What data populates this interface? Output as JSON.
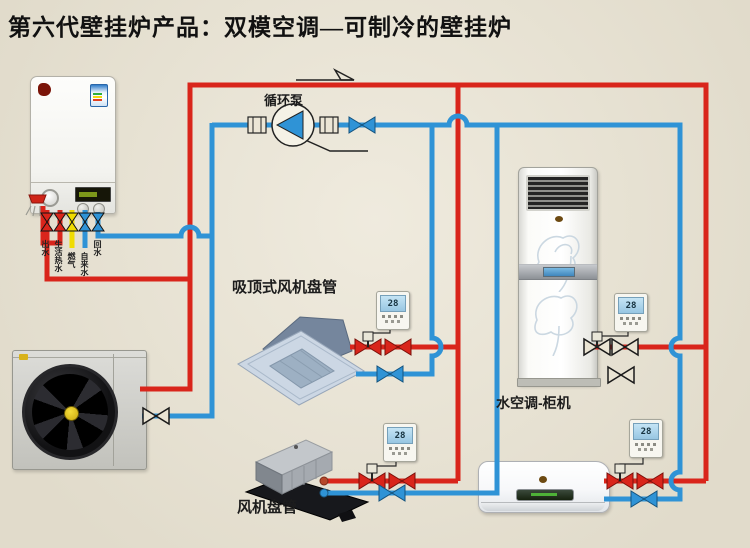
{
  "title": "第六代壁挂炉产品：双模空调—可制冷的壁挂炉",
  "colors": {
    "background": "#EAE4D3",
    "pipe_hot": "#D9251B",
    "pipe_cold": "#2F93D6",
    "pipe_gas": "#F0DC00",
    "accent_dark": "#222222"
  },
  "labels": {
    "pump": "循环泵",
    "cassette": "吸顶式风机盘管",
    "floor_unit": "水空调-柜机",
    "fan_coil": "风机盘管"
  },
  "boiler": {
    "ports": [
      {
        "label": "出水"
      },
      {
        "label": "生活热水"
      },
      {
        "label": "燃气"
      },
      {
        "label": "自来水"
      },
      {
        "label": "回水"
      }
    ]
  },
  "thermostats": [
    {
      "value": "28"
    },
    {
      "value": "28"
    },
    {
      "value": "28"
    },
    {
      "value": "28"
    }
  ]
}
